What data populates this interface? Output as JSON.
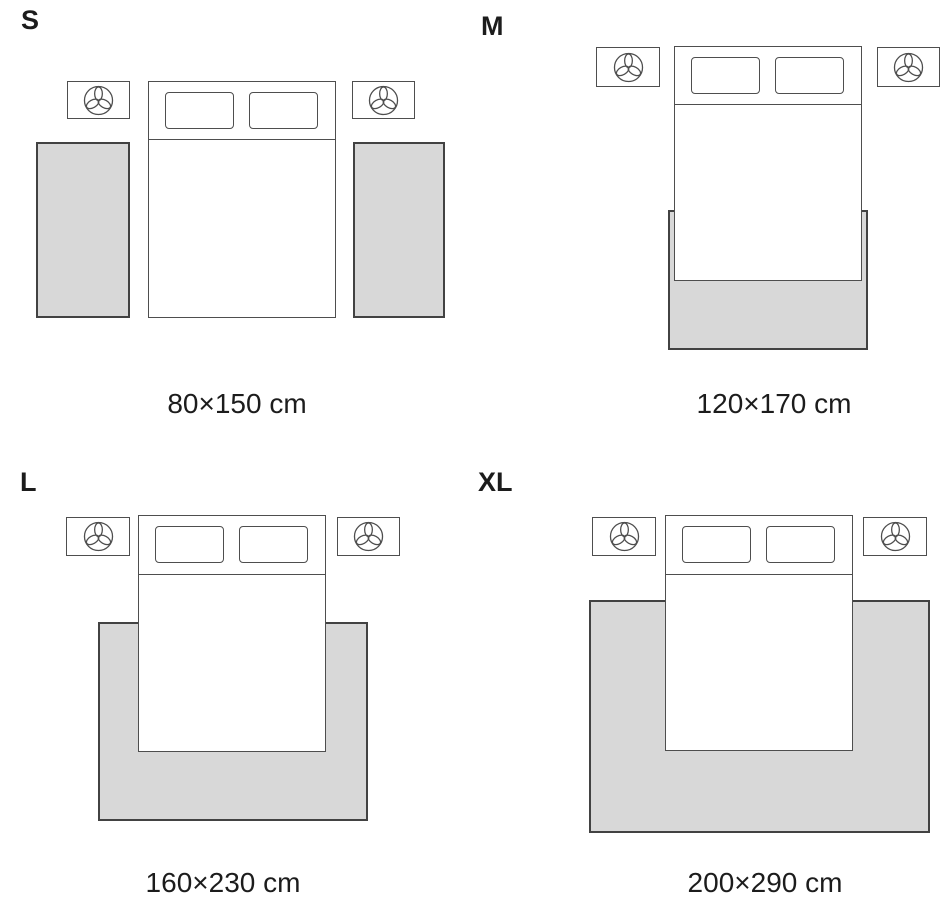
{
  "variants": [
    {
      "label": "S",
      "dimensions": "80×150 cm"
    },
    {
      "label": "M",
      "dimensions": "120×170 cm"
    },
    {
      "label": "L",
      "dimensions": "160×230 cm"
    },
    {
      "label": "XL",
      "dimensions": "200×290 cm"
    }
  ],
  "icons": {
    "nightstand_lamp": "lamp-icon"
  },
  "colors": {
    "background": "#ffffff",
    "rug_fill": "#d8d8d8",
    "rug_border": "#424242",
    "furniture_border": "#4e4e4e",
    "text": "#1c1c1c"
  }
}
